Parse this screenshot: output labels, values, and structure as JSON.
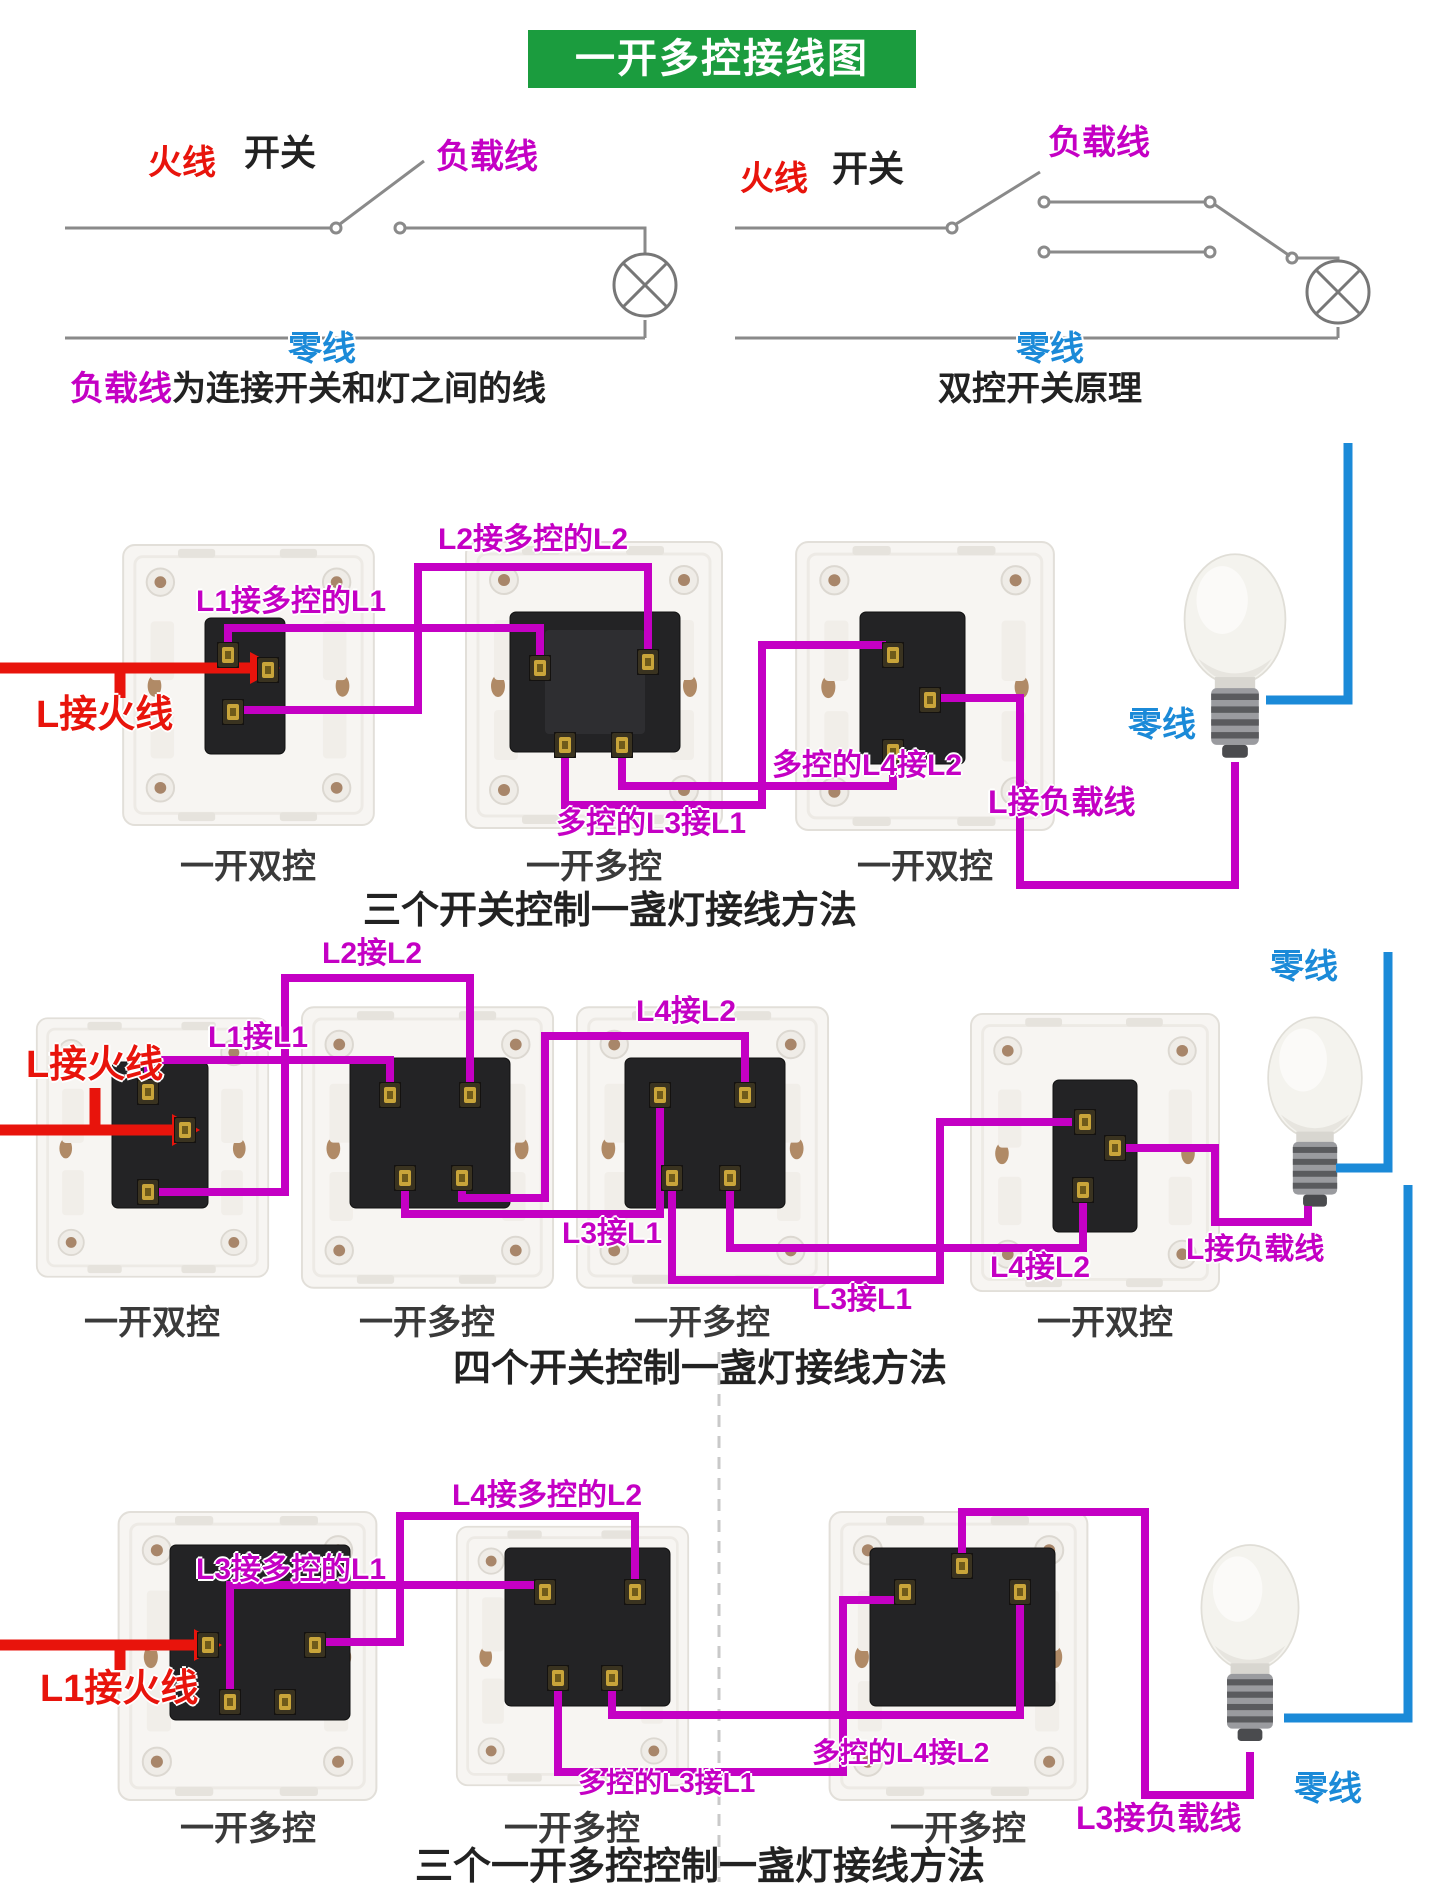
{
  "title": "一开多控接线图",
  "colors": {
    "green": "#1b9c3e",
    "red": "#e8140c",
    "purple": "#c400c4",
    "blue": "#1b8ad8",
    "dark": "#3a3a3a"
  },
  "schematics": {
    "left": {
      "live_label": "火线",
      "switch_label": "开关",
      "load_label": "负载线",
      "neutral_label": "零线",
      "caption_highlight": "负载线",
      "caption_rest": "为连接开关和灯之间的线"
    },
    "right": {
      "live_label": "火线",
      "switch_label": "开关",
      "load_label": "负载线",
      "neutral_label": "零线",
      "caption": "双控开关原理"
    }
  },
  "sections": {
    "three": {
      "caption": "三个开关控制一盏灯接线方法",
      "switch_captions": [
        "一开双控",
        "一开多控",
        "一开双控"
      ],
      "labels": {
        "l1": "L1接多控的L1",
        "l2": "L2接多控的L2",
        "live": "L接火线",
        "l3": "多控的L3接L1",
        "l4": "多控的L4接L2",
        "load": "L接负载线",
        "neutral": "零线"
      }
    },
    "four": {
      "caption": "四个开关控制一盏灯接线方法",
      "switch_captions": [
        "一开双控",
        "一开多控",
        "一开多控",
        "一开双控"
      ],
      "labels": {
        "l1": "L1接L1",
        "l2": "L2接L2",
        "l4_top": "L4接L2",
        "live": "L接火线",
        "l3_a": "L3接L1",
        "l3_b": "L3接L1",
        "l4_b": "L4接L2",
        "load": "L接负载线",
        "neutral": "零线"
      }
    },
    "multi": {
      "caption": "三个一开多控控制一盏灯接线方法",
      "switch_captions": [
        "一开多控",
        "一开多控",
        "一开多控"
      ],
      "labels": {
        "l3": "L3接多控的L1",
        "l4": "L4接多控的L2",
        "live": "L1接火线",
        "l3_b": "多控的L3接L1",
        "l4_b": "多控的L4接L2",
        "load": "L3接负载线",
        "neutral": "零线"
      }
    }
  }
}
